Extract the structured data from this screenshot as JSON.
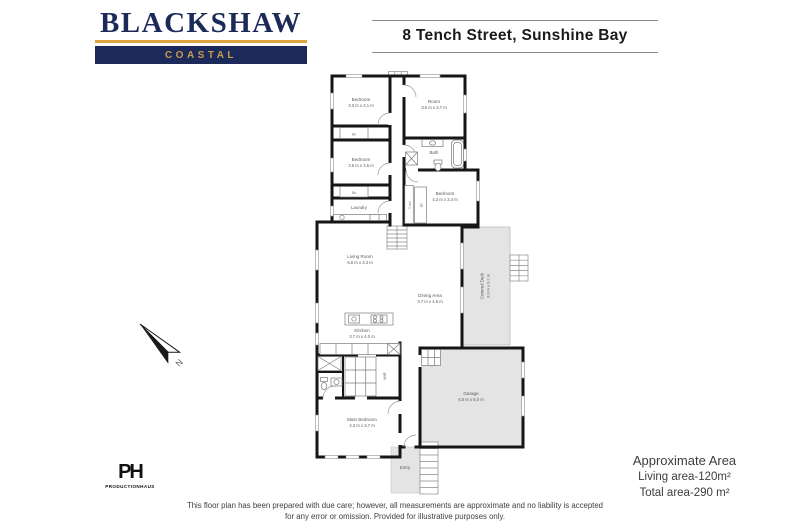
{
  "brand": {
    "name": "BLACKSHAW",
    "tagline": "COASTAL"
  },
  "header": {
    "title": "8 Tench Street, Sunshine Bay"
  },
  "compass": {
    "north": "N"
  },
  "rooms": {
    "bedroom1": {
      "name": "Bedroom",
      "dims": "3.3 m x 3.1 m"
    },
    "room": {
      "name": "Room",
      "dims": "3.5 m x 3.7 m"
    },
    "bedroom2": {
      "name": "Bedroom",
      "dims": "3.5 m x 3.5 m"
    },
    "bath": {
      "name": "Bath"
    },
    "bedroom3": {
      "name": "Bedroom",
      "dims": "4.3 m x 3.4 m"
    },
    "laundry": {
      "name": "Laundry"
    },
    "living": {
      "name": "Living Room",
      "dims": "6.6 m x 3.4 m"
    },
    "dining": {
      "name": "Dining Area",
      "dims": "3.7 m x 4.6 m"
    },
    "kitchen": {
      "name": "Kitchen",
      "dims": "3.7 m x 4.0 m"
    },
    "deck": {
      "name": "Covered Deck",
      "dims": "3.0 m x 9.2 m"
    },
    "wir": {
      "name": "WIR"
    },
    "main_bedroom": {
      "name": "Main Bedroom",
      "dims": "4.3 m x 3.7 m"
    },
    "garage": {
      "name": "Garage",
      "dims": "6.0 m x 6.0 m"
    },
    "entry": {
      "name": "Entry"
    },
    "robe": {
      "name": "Br"
    },
    "cupboard": {
      "name": "Cupd"
    }
  },
  "area_summary": {
    "title": "Approximate Area",
    "living": "Living area-120m²",
    "total": "Total area-290 m²"
  },
  "disclaimer": {
    "line1": "This floor plan has been prepared with due care; however, all measurements are approximate and no liability is accepted",
    "line2": "for any error or omission. Provided for illustrative purposes only."
  },
  "credit": {
    "monogram": "PH",
    "name": "PRODUCTIONHAUS"
  },
  "colors": {
    "navy": "#1c2a5a",
    "gold": "#dfa33e",
    "wall": "#161616",
    "floor_shade": "#e4e4e4"
  }
}
